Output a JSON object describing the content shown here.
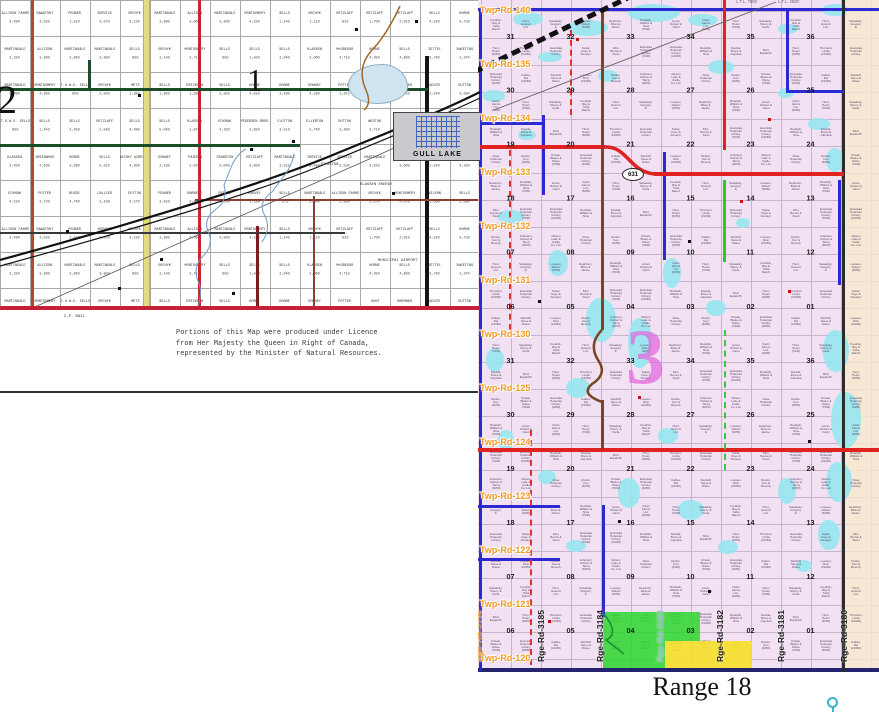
{
  "left_map": {
    "township_number_left": "2",
    "township_number_right": "1",
    "town_name": "GULL LAKE",
    "cp_rail_label": "C.P. RAIL",
    "special_labels": {
      "municipal_airport": "MUNICIPAL AIRPORT",
      "klassen_energy": "KLASSEN ENERGY",
      "johnston": "JOHNSTON"
    },
    "licence_note_lines": [
      "Portions of this Map were produced under Licence",
      "from Her Majesty the Queen in Right of Canada,",
      "represented by the Minister of Natural Resources."
    ],
    "parcels": [
      {
        "n": "ALLISON FARMS",
        "v": "3,490"
      },
      {
        "n": "CRANSTON",
        "v": "3,040"
      },
      {
        "n": "ADLER",
        "v": "1,540"
      },
      {
        "n": "DUTTON",
        "v": "3,570"
      },
      {
        "n": "DUTTON",
        "v": "3,450"
      },
      {
        "n": "SAWATSKY",
        "v": "3,020"
      },
      {
        "n": "RETZLAFF",
        "v": "3,050"
      },
      {
        "n": "DUTTON",
        "v": "3,580"
      },
      {
        "n": "PENNER",
        "v": "3,550"
      },
      {
        "n": "WESTON",
        "v": "3,710"
      },
      {
        "n": "PENNER",
        "v": "1,510"
      },
      {
        "n": "MARTINDALE",
        "v": "3,510"
      },
      {
        "n": "FRIESE",
        "v": "3,490"
      },
      {
        "n": "BARNETT",
        "v": "3,040"
      },
      {
        "n": "ORCHYK",
        "v": "2,400"
      },
      {
        "n": "SERVICE",
        "v": "3,570"
      },
      {
        "n": "SERVICE",
        "v": "3,490"
      },
      {
        "n": "MARTINDALE",
        "v": "3,320"
      },
      {
        "n": "FRIESE",
        "v": "4,060"
      },
      {
        "n": "WESTON",
        "v": "3,760"
      },
      {
        "n": "ORCHYK",
        "v": "3,220"
      },
      {
        "n": "SERVICE",
        "v": "3,520"
      },
      {
        "n": "ALLISON",
        "v": "3,380"
      },
      {
        "n": "HARVEY",
        "v": "3,390"
      },
      {
        "n": "MARTINDALE",
        "v": "3,240"
      },
      {
        "n": "MARTINDALE",
        "v": "3,980"
      },
      {
        "n": "MARTINDALE",
        "v": "3,810"
      },
      {
        "n": "MARTINDALE",
        "v": "3,860"
      },
      {
        "n": "SELLS",
        "v": "875"
      },
      {
        "n": "FISCHETTA",
        "v": "840"
      },
      {
        "n": "ALLISON",
        "v": "3,060"
      },
      {
        "n": "HARVEY",
        "v": "3,660"
      },
      {
        "n": "MARTINDALE",
        "v": "3,950"
      },
      {
        "n": "MARTINDALE",
        "v": "3,900"
      },
      {
        "n": "MARTINDALE",
        "v": "3,490"
      },
      {
        "n": "MARTINDALE",
        "v": "3,930"
      },
      {
        "n": "MARTINDALE",
        "v": "1,520"
      },
      {
        "n": "SELLS",
        "v": "850"
      },
      {
        "n": "ALLISON FARMS",
        "v": "3,950"
      },
      {
        "n": "MONTGOMERY",
        "v": "4,380"
      },
      {
        "n": "MONTGOMERY",
        "v": "4,320"
      },
      {
        "n": "MARTINDALE",
        "v": "4,250"
      },
      {
        "n": "ORCHYK",
        "v": "3,140"
      },
      {
        "n": "ORCHYK",
        "v": "1,670"
      },
      {
        "n": "T.G.W.O. SELLS",
        "v": "850"
      },
      {
        "n": "SELLS",
        "v": "1,140"
      },
      {
        "n": "WILSON",
        "v": "840"
      },
      {
        "n": "MONTGOMERY",
        "v": "3,710"
      },
      {
        "n": "MONTGOMERY",
        "v": "4,670"
      },
      {
        "n": "ORCHYK",
        "v": "2,920"
      },
      {
        "n": "ORCHYK",
        "v": "1,110"
      },
      {
        "n": "T.G.W.O. SELLS",
        "v": "850"
      },
      {
        "n": "SELLS",
        "v": "850"
      },
      {
        "n": "WILSON",
        "v": "1,660"
      },
      {
        "n": "METZ",
        "v": "1,380"
      },
      {
        "n": "RETZLAFF",
        "v": "833"
      },
      {
        "n": "SELLS",
        "v": "1,443"
      },
      {
        "n": "SELLS",
        "v": "1,503"
      },
      {
        "n": "SELLS",
        "v": "3,580"
      },
      {
        "n": "SELLS",
        "v": "1,983"
      },
      {
        "n": "RETZLAFF",
        "v": "1,700"
      },
      {
        "n": "SELLS",
        "v": "2,450"
      },
      {
        "n": "SELLS",
        "v": "2,040"
      },
      {
        "n": "METZ",
        "v": "1,260"
      },
      {
        "n": "ERICKSON",
        "v": "1,580"
      },
      {
        "n": "RETZLAFF",
        "v": "2,010"
      },
      {
        "n": "RETZLAFF",
        "v": "2,540"
      },
      {
        "n": "KLASSEN",
        "v": "3,060"
      },
      {
        "n": "KLASSEN",
        "v": "3,450"
      },
      {
        "n": "SELLS",
        "v": "2,350"
      },
      {
        "n": "SELLS",
        "v": "4,520"
      },
      {
        "n": "SELLS",
        "v": "4,480"
      },
      {
        "n": "McGREGOR",
        "v": "4,710"
      },
      {
        "n": "GREENWOOD",
        "v": "4,630"
      },
      {
        "n": "HORNE",
        "v": "4,610"
      },
      {
        "n": "HORNE",
        "v": "3,730"
      },
      {
        "n": "SELLS",
        "v": "5,040"
      },
      {
        "n": "HORNE",
        "v": "4,350"
      },
      {
        "n": "HORNE",
        "v": "3,380"
      },
      {
        "n": "HORNE",
        "v": "3,430"
      },
      {
        "n": "KLASSEN",
        "v": "1,450"
      },
      {
        "n": "KLASSEN",
        "v": "1,870"
      },
      {
        "n": "SELLS",
        "v": "4,890"
      },
      {
        "n": "SELLS",
        "v": "5,310"
      },
      {
        "n": "DOWNEY",
        "v": "4,330"
      },
      {
        "n": "ECKMAN",
        "v": "4,150"
      },
      {
        "n": "ECKMAN",
        "v": "4,320"
      },
      {
        "n": "ZETTEL",
        "v": "3,760"
      },
      {
        "n": "SAWATSKY ACRES LTD.",
        "v": "4,350"
      },
      {
        "n": "POTTER",
        "v": "1,975"
      },
      {
        "n": "POTTER",
        "v": "3,720"
      },
      {
        "n": "PEDERSEN BROS.",
        "v": "2,850"
      },
      {
        "n": "SWEETING",
        "v": "2,370"
      },
      {
        "n": "DOWNEY",
        "v": "2,190"
      },
      {
        "n": "HUNT",
        "v": "3,450"
      },
      {
        "n": "BUSSE",
        "v": "4,740"
      },
      {
        "n": "CLUTTON",
        "v": "3,510"
      },
      {
        "n": "HAMILTON",
        "v": "3,740"
      },
      {
        "n": "THUESON",
        "v": "2,630"
      },
      {
        "n": "BREMNER",
        "v": "3,503"
      },
      {
        "n": "CALLIES",
        "v": "3,109"
      },
      {
        "n": "ELLERTON",
        "v": "5,740"
      }
    ]
  },
  "right_map": {
    "twp_road_labels": [
      "Twp-Rd-140",
      "Twp-Rd-135",
      "Twp-Rd-134",
      "Twp-Rd-133",
      "Twp-Rd-132",
      "Twp-Rd-131",
      "Twp-Rd-130",
      "Twp-Rd-125",
      "Twp-Rd-124",
      "Twp-Rd-123",
      "Twp-Rd-122",
      "Twp-Rd-121",
      "Twp-Rd-120"
    ],
    "rge_road_labels": [
      {
        "text": "Rge-Rd-3185",
        "tone": "dark"
      },
      {
        "text": "Rge-Rd-3184",
        "tone": "dark"
      },
      {
        "text": "Rge-Rd-3183",
        "tone": "light"
      },
      {
        "text": "Rge-Rd-3182",
        "tone": "dark"
      },
      {
        "text": "Rge-Rd-3181",
        "tone": "dark"
      },
      {
        "text": "Rge-Rd-3180",
        "tone": "dark"
      }
    ],
    "rge_road_left_label": "Rge-Rd-3190",
    "township_number": "3",
    "highway_shield": "631",
    "top_edge_labels": [
      "L.T.L. 7800",
      "L.T.L. 2500"
    ],
    "section_rows": [
      [
        "31",
        "32",
        "33",
        "34",
        "35",
        "36"
      ],
      [
        "30",
        "29",
        "28",
        "27",
        "26",
        "25"
      ],
      [
        "19",
        "20",
        "21",
        "22",
        "23",
        "24"
      ],
      [
        "18",
        "17",
        "16",
        "15",
        "14",
        "13"
      ],
      [
        "07",
        "08",
        "09",
        "10",
        "11",
        "12"
      ],
      [
        "06",
        "05",
        "04",
        "03",
        "02",
        "01"
      ],
      [
        "31",
        "32",
        "33",
        "34",
        "35",
        "36"
      ],
      [
        "30",
        "29",
        "28",
        "27",
        "26",
        "25"
      ],
      [
        "19",
        "20",
        "21",
        "22",
        "23",
        "24"
      ],
      [
        "18",
        "17",
        "16",
        "15",
        "14",
        "13"
      ],
      [
        "07",
        "08",
        "09",
        "10",
        "11",
        "12"
      ],
      [
        "06",
        "05",
        "04",
        "03",
        "02",
        "01"
      ]
    ],
    "parcel_names": [
      "Fredrick, Ray & Twila Ranch",
      "Diedda, Bruce & Capriela",
      "Gibson Lake & Cattle Co. Ltd.",
      "Hunt, Everett Ltd.",
      "Shirl, Espald B.",
      "Rose Hutterian Colony",
      "Sawatsky, Gregory &",
      "Hunt, Helen (6250)",
      "Dutton, Ken (6250)",
      "Loewen, Robert (6250)",
      "Thornton, Linda (21060)",
      "Kirwan, Blaine & Diane (7930)",
      "Dearborn, Brian & Janine",
      "Evaniska Hutterian Colony",
      "Evaniska Hutterian Colony (6250)",
      "Rudolph, William & Nina (7930)",
      "Suttar, Faye & Develyn",
      "Callies, Del (21060)",
      "Loran, Robert & Carol",
      "Klim, Bernie & Pearl",
      "Retzlaff, Steve & Diane",
      "Fielin Farms Ltd. (6250)",
      "Evaniska Hutterian Colony (7930)",
      "Loewen, Dion (21060)",
      "Hunt, Helen (7930)",
      "Evaniska Hutterian Colony (21060)",
      "Dutton, Ken & Beverly",
      "Sawatsky, Sherry & Carla",
      "Rudolph, William & Nina",
      "Johnston, Robert & Tanny (6250)"
    ],
    "range_caption": "Range 18"
  }
}
